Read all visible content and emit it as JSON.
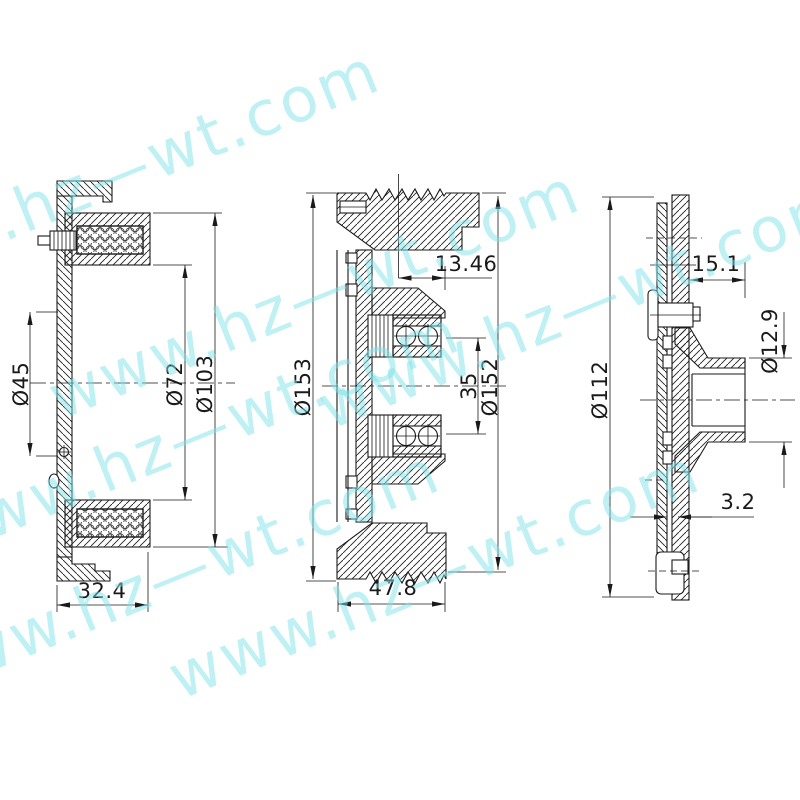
{
  "watermark": {
    "text": "www.hz—wt.com",
    "color": "#7fe3ea"
  },
  "drawing": {
    "line_color": "#1a1a1a",
    "background": "#ffffff"
  },
  "views": {
    "coil_side": {
      "name": "coil-side-view",
      "dims": {
        "inner_dia": "Ø45",
        "winding_dia": "Ø72",
        "outer_dia": "Ø103",
        "depth": "32.4"
      }
    },
    "pulley_section": {
      "name": "pulley-section-view",
      "dims": {
        "outer_dia": "Ø153",
        "groove_offset": "13.46",
        "bore_dia": "35",
        "face_dia": "Ø152",
        "width": "47.8"
      }
    },
    "hub_side": {
      "name": "hub-side-view",
      "dims": {
        "outer_dia": "Ø112",
        "boss_length": "15.1",
        "shaft_dia": "Ø12.9",
        "plate_thickness": "3.2"
      }
    }
  }
}
